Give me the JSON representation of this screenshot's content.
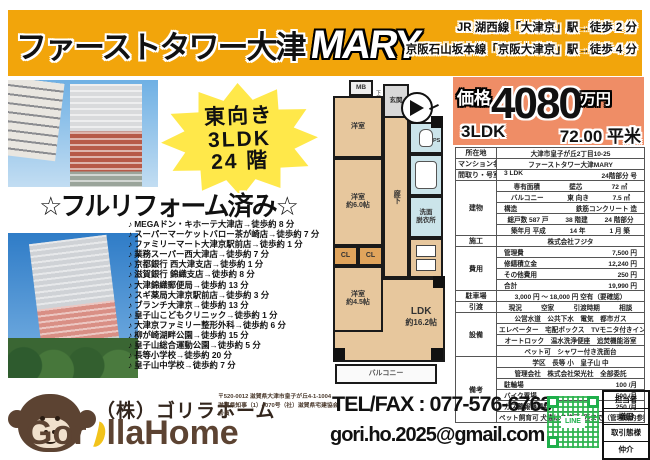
{
  "header": {
    "title_jp": "ファーストタワー大津",
    "title_en": "MARY",
    "access_line1": "JR 湖西線「大津京」駅→徒歩 2 分",
    "access_line2": "京阪石山坂本線「京阪大津京」駅→徒歩 4 分"
  },
  "badge": {
    "line1": "東向き",
    "line2": "3LDK",
    "line3": "24 階"
  },
  "reform_banner": "☆フルリフォーム済み☆",
  "price": {
    "label": "価格",
    "value": "4080",
    "unit": "万円",
    "layout": "3LDK",
    "area": "72.00 平米"
  },
  "facilities": {
    "bullet": "♪",
    "items": [
      "MEGAドン・キホーテ大津店→徒歩約 8 分",
      "スーパーマーケットバロー茶が崎店→徒歩約 7 分",
      "ファミリーマート大津京駅前店→徒歩約 1 分",
      "業務スーパー西大津店→徒歩約 7 分",
      "京都銀行 西大津支店→徒歩約 1 分",
      "滋賀銀行 錦織支店→徒歩約 8 分",
      "大津錦織郵便局→徒歩約 13 分",
      "スギ薬局大津京駅前店→徒歩約 3 分",
      "ブランチ大津京→徒歩約 13 分",
      "皇子山こどもクリニック→徒歩約 1 分",
      "大津京ファミリー整形外科→徒歩約 6 分",
      "柳が崎湖畔公園→徒歩約 15 分",
      "皇子山総合運動公園→徒歩約 5 分",
      "長等小学校→徒歩約 20 分",
      "皇子山中学校→徒歩約 7 分"
    ]
  },
  "floorplan": {
    "mb": "MB",
    "entrance": "玄関",
    "shoe": "下足",
    "room_top": "洋室",
    "room_mid_1": "洋室",
    "room_mid_2": "約6.0帖",
    "closet1": "CL",
    "closet2": "CL",
    "room_low_1": "洋室",
    "room_low_2": "約4.5帖",
    "hall": "廊下",
    "ps": "PS",
    "wash_1": "洗面",
    "wash_2": "脱衣所",
    "ldk_1": "LDK",
    "ldk_2": "約16.2帖",
    "balcony": "バルコニー"
  },
  "spec_table": {
    "rows": [
      {
        "label": "所在地",
        "span": 1,
        "cells": [
          "大津市皇子が丘2丁目10-25"
        ]
      },
      {
        "label": "マンション名",
        "span": 1,
        "cells": [
          "ファーストタワー大津MARY"
        ]
      },
      {
        "label": "間取り・号室",
        "span": 1,
        "cells": [
          "3 LDK",
          "24階部分 号"
        ]
      },
      {
        "label": "建物",
        "span": 5,
        "cells": [
          "専有面積",
          "壁芯",
          "72 ㎡"
        ]
      },
      {
        "cells": [
          "バルコニー",
          "東 向き",
          "7.5 ㎡"
        ]
      },
      {
        "cells": [
          "構造",
          "鉄筋コンクリート 造"
        ]
      },
      {
        "cells": [
          "総戸数 587 戸",
          "38 階建",
          "24 階部分"
        ]
      },
      {
        "cells": [
          "築年月 平成",
          "14 年",
          "1 月 築"
        ]
      },
      {
        "label": "施工",
        "span": 1,
        "cells": [
          "株式会社フジタ"
        ]
      },
      {
        "label": "費用",
        "span": 4,
        "cells": [
          "管理費",
          "7,500 円"
        ]
      },
      {
        "cells": [
          "修繕積立金",
          "12,240 円"
        ]
      },
      {
        "cells": [
          "その他費用",
          "250 円"
        ]
      },
      {
        "cells": [
          "合計",
          "19,990 円"
        ]
      },
      {
        "label": "駐車場",
        "span": 1,
        "cells": [
          "3,000 円 ～ 18,000 円 空有（要確認）"
        ]
      },
      {
        "label": "引渡",
        "span": 1,
        "cells": [
          "現況",
          "空家",
          "引渡時期",
          "相談"
        ]
      },
      {
        "label": "設備",
        "span": 4,
        "cells": [
          "公営水道　公共下水　電気　都市ガス"
        ]
      },
      {
        "cells": [
          "エレベーター　宅配ボックス　TVモニタ付きインターホン"
        ]
      },
      {
        "cells": [
          "オートロック　温水洗浄便座　追焚機能浴室"
        ]
      },
      {
        "cells": [
          "ペット可　シャワー付き洗面台"
        ]
      },
      {
        "label": "備考",
        "span": 6,
        "cells": [
          "学区　長等 小　皇子山 中"
        ]
      },
      {
        "cells": [
          "管理会社　株式会社栄光社　全部委託"
        ]
      },
      {
        "cells": [
          "駐輪場",
          "100 /月"
        ]
      },
      {
        "cells": [
          "バイク置場",
          "500 /月"
        ]
      },
      {
        "cells": [
          "ガス警報器賃料",
          "250 /月"
        ]
      },
      {
        "cells": [
          "ペット飼育可 犬猫は各住戸1匹まで（管理規約参照）"
        ]
      }
    ]
  },
  "footer": {
    "company": "（株）ゴリラホーム",
    "postal": "〒520-0012 滋賀県大津市皇子が丘4-1-1004",
    "license": "滋賀県知事（1）4070号（社）滋賀県宅建協会会員",
    "logo_part1": "Gor",
    "logo_part2": "llaHome",
    "telfax": "TEL/FAX : 077-576-6763",
    "email": "gori.ho.2025@gmail.com",
    "qr_label": "LINE",
    "agent": {
      "r1": "担当者",
      "r2": "増田",
      "r3": "取引態様",
      "r4": "仲介"
    }
  }
}
